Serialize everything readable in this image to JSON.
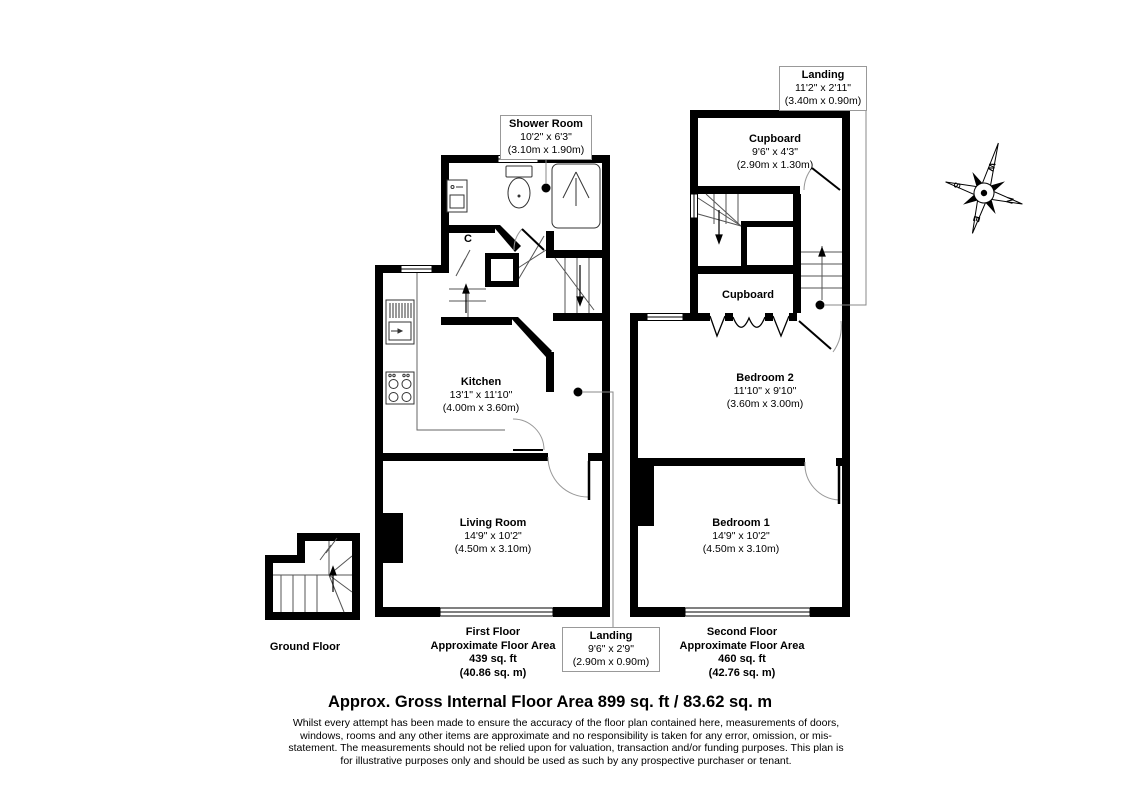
{
  "page": {
    "title": "Approx. Gross Internal Floor Area 899 sq. ft / 83.62 sq. m",
    "disclaimer": "Whilst every attempt has been made to ensure the accuracy of the floor plan contained here, measurements of doors, windows, rooms and any other items are approximate and no responsibility is taken for any error, omission, or mis-statement. The measurements should not be relied upon for valuation, transaction and/or funding purposes. This plan is for illustrative purposes only and should be used as such by any prospective purchaser or tenant."
  },
  "floors": {
    "ground": {
      "label": "Ground Floor"
    },
    "first": {
      "label": "First Floor",
      "area_label": "Approximate Floor Area",
      "area_ft": "439 sq. ft",
      "area_m": "(40.86 sq. m)"
    },
    "second": {
      "label": "Second Floor",
      "area_label": "Approximate Floor Area",
      "area_ft": "460 sq. ft",
      "area_m": "(42.76 sq. m)"
    }
  },
  "rooms": {
    "shower_room": {
      "name": "Shower Room",
      "dims_ft": "10'2\" x 6'3\"",
      "dims_m": "(3.10m x 1.90m)"
    },
    "kitchen": {
      "name": "Kitchen",
      "dims_ft": "13'1\" x 11'10\"",
      "dims_m": "(4.00m x 3.60m)"
    },
    "living_room": {
      "name": "Living Room",
      "dims_ft": "14'9\" x 10'2\"",
      "dims_m": "(4.50m x 3.10m)"
    },
    "landing_first": {
      "name": "Landing",
      "dims_ft": "9'6\" x 2'9\"",
      "dims_m": "(2.90m x 0.90m)"
    },
    "landing_second": {
      "name": "Landing",
      "dims_ft": "11'2\" x 2'11\"",
      "dims_m": "(3.40m x 0.90m)"
    },
    "cupboard_second": {
      "name": "Cupboard",
      "dims_ft": "9'6\" x 4'3\"",
      "dims_m": "(2.90m x 1.30m)"
    },
    "cupboard_small": {
      "name": "Cupboard"
    },
    "bedroom_2": {
      "name": "Bedroom 2",
      "dims_ft": "11'10\" x 9'10\"",
      "dims_m": "(3.60m x 3.00m)"
    },
    "bedroom_1": {
      "name": "Bedroom 1",
      "dims_ft": "14'9\" x 10'2\"",
      "dims_m": "(4.50m x 3.10m)"
    },
    "closet": {
      "name": "C"
    }
  },
  "compass": {
    "north": "N",
    "east": "E",
    "south": "S",
    "west": "W"
  },
  "colors": {
    "wall": "#000000",
    "detail_line": "#555555",
    "arc_line": "#999999",
    "callout_border": "#999999"
  }
}
